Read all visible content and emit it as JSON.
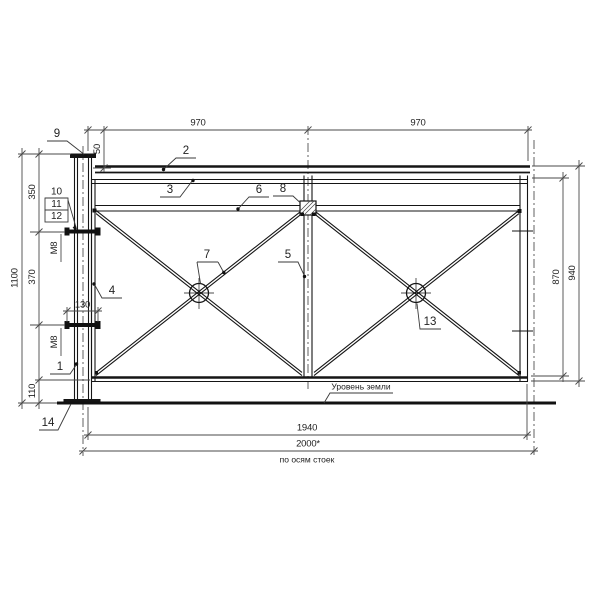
{
  "dims": {
    "span_left": "970",
    "span_right": "970",
    "top_inset": "50",
    "seg_350": "350",
    "seg_370": "370",
    "seg_110": "110",
    "total_1100": "1100",
    "clamp_130": "130",
    "right_870": "870",
    "right_940": "940",
    "bottom_1940": "1940",
    "bottom_2000": "2000*",
    "bottom_note": "по осям стоек",
    "m8_upper": "M8",
    "m8_lower": "M8"
  },
  "labels": {
    "ground": "Уровень земли"
  },
  "callouts": {
    "pos1": "1",
    "pos2": "2",
    "pos3": "3",
    "pos4": "4",
    "pos5": "5",
    "pos6": "6",
    "pos7": "7",
    "pos8": "8",
    "pos9": "9",
    "pos10": "10",
    "pos11": "11",
    "pos12": "12",
    "pos13": "13",
    "pos14": "14"
  }
}
